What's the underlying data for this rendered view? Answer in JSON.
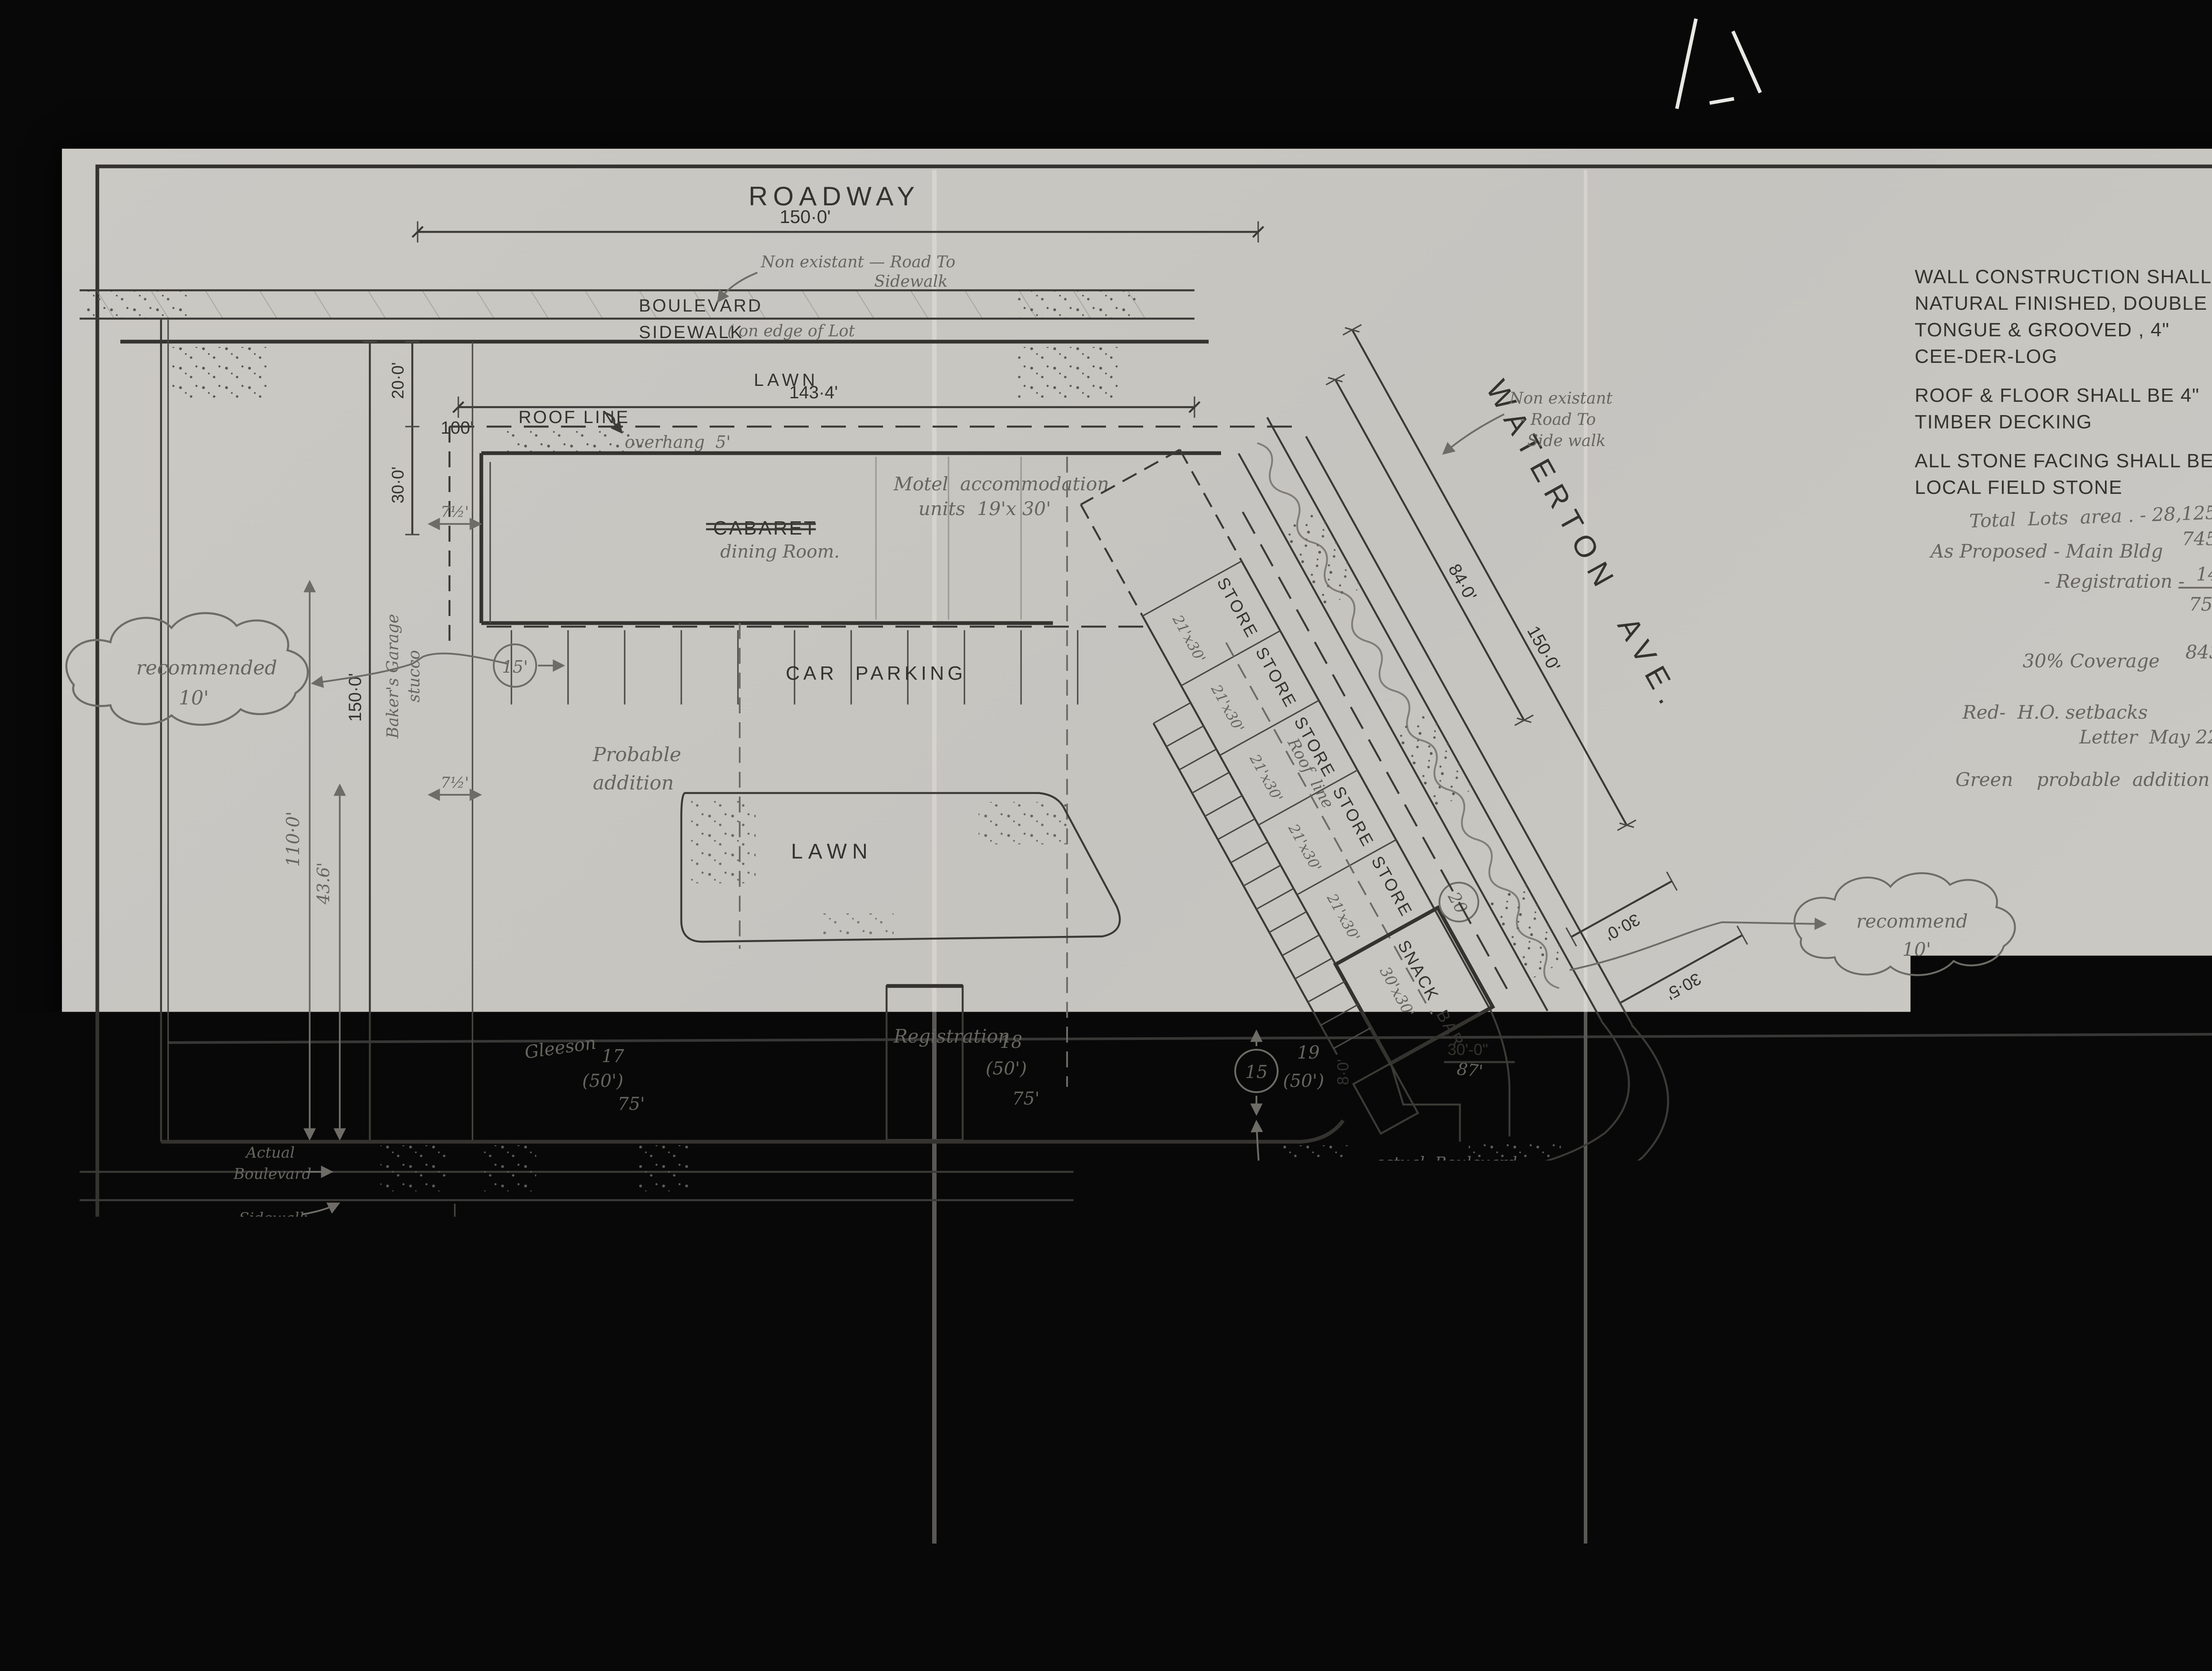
{
  "film": {
    "counter": "001679"
  },
  "archive": {
    "ref_line1": "RG 84, A-2-a, vol. 2184",
    "ref_line2": "File/dossier W21-3-17",
    "ref_line3": "pt 1",
    "dept_line1": "Parks Canada",
    "dept_line2": "Parcs Canada",
    "org_line1": "National Archives of Canada",
    "org_line2": "Archives nationales du Canada"
  },
  "specs": {
    "l1": "WALL CONSTRUCTION SHALL BE",
    "l2": "NATURAL FINISHED, DOUBLE",
    "l3": "TONGUE & GROOVED , 4\"",
    "l4": "CEE-DER-LOG",
    "l5": "ROOF & FLOOR SHALL BE 4\"",
    "l6": "TIMBER DECKING",
    "l7": "ALL STONE FACING SHALL BE",
    "l8": "LOCAL FIELD STONE"
  },
  "calc": {
    "row1": "Total  Lots  area . - 28,125 □ approx",
    "row2": "As Proposed - Main Bldg",
    "row2_val": "7455 □ approx",
    "row3": "- Registration -",
    "num": "144",
    "den": "7599",
    "row4": "30% Coverage",
    "row4_val": "8437.5 □"
  },
  "legend": {
    "red1": "Red-  H.O. setbacks",
    "red2": "Letter  May 22 '58",
    "green": "Green    probable  addition"
  },
  "roads": {
    "roadway": "ROADWAY",
    "boulevard": "BOULEVARD",
    "sidewalk": "SIDEWALK",
    "sidewalk_note": "( on edge of Lot",
    "mountview": "MOUNTVIEW  ROAD",
    "waterton": "WATERTON  AVE."
  },
  "areas": {
    "lawn_top": "LAWN",
    "lawn": "LAWN",
    "car_parking": "CAR  PARKING",
    "cabaret": "CABARET",
    "dining": "dining Room.",
    "registration": "Registration",
    "snack": "SNACK  BAR",
    "snack_size": "30'x30'",
    "motel1": "Motel  accommodation",
    "motel2": "units  19'x 30'",
    "probable1": "Probable",
    "probable2": "addition",
    "roofline": "ROOF LINE",
    "roofline_diag": "Roof  line",
    "overhang": "overhang  5'"
  },
  "stores": {
    "name": "STORE",
    "size": "21'x30'"
  },
  "dims": {
    "top150": "150·0'",
    "d143": "143·4'",
    "d100": "100'",
    "d20": "20·0'",
    "d30": "30·0'",
    "d150": "150·0'",
    "d110": "110·0'",
    "d436": "43.6'",
    "d75a": "7½'",
    "d75b": "7½'",
    "d237": "237·0'",
    "d84": "84·0'",
    "d150w": "150·0'",
    "d30w": "30·0'",
    "d305": "30·5'",
    "d300": "30'-0\"",
    "d8": "8·0'",
    "d87": "87'"
  },
  "lots": {
    "l17": "17",
    "l17b": "(50')",
    "l17c": "75'",
    "l17name": "Gleeson",
    "l18": "18",
    "l18b": "(50')",
    "l18c": "75'",
    "l19": "19",
    "l19b": "(50')",
    "c15a": "15'",
    "c15b": "15",
    "c20": "20"
  },
  "notes": {
    "nonexist1a": "Non existant — Road To",
    "nonexist1b": "Sidewalk",
    "nonexist2a": "Non existant",
    "nonexist2b": "- Road To",
    "nonexist2c": "Side walk",
    "actual_blvd": "actual  Boulevard",
    "actual_sw": "actual  sidewalk",
    "left1": "Actual",
    "left2": "Boulevard",
    "left3": "Sidewalk",
    "inline1": "in line with Treed",
    "inline2": "Boulevard  Blk II",
    "store_front": "actual store fronts",
    "private_sw": "sidewalk on private property",
    "blk": "Block III",
    "lots1925": "Lots 19-25",
    "bakers1": "Baker's Garage",
    "bakers2": "stucco"
  },
  "clouds": {
    "left1": "recommended",
    "left2": "10'",
    "right1": "recommend",
    "right2": "10'",
    "bottom1": "recommend",
    "bottom2": "8'"
  },
  "plan_title": {
    "t": "PLOT PLAN",
    "s": "SCALE :  1\" = 20'-0\""
  },
  "titleblock": {
    "l1": "TIMBER  BUILDING",
    "l2": "SUPPLIES  LTD.",
    "l3": "CALGARY.  ALTA.",
    "lots": "Lots  17-18-19    Blk III",
    "date": "July 19, 1958",
    "file": "FILE No. 58-241"
  },
  "titlebar": {
    "part1": "\"MARDEL\"   -   STORES , MOTEL   &",
    "struck": "CABARET.",
    "part2": "-   WATERTON  LAKES   TOWNSITE . -   ALBERTA .",
    "dining": "dining Room"
  }
}
